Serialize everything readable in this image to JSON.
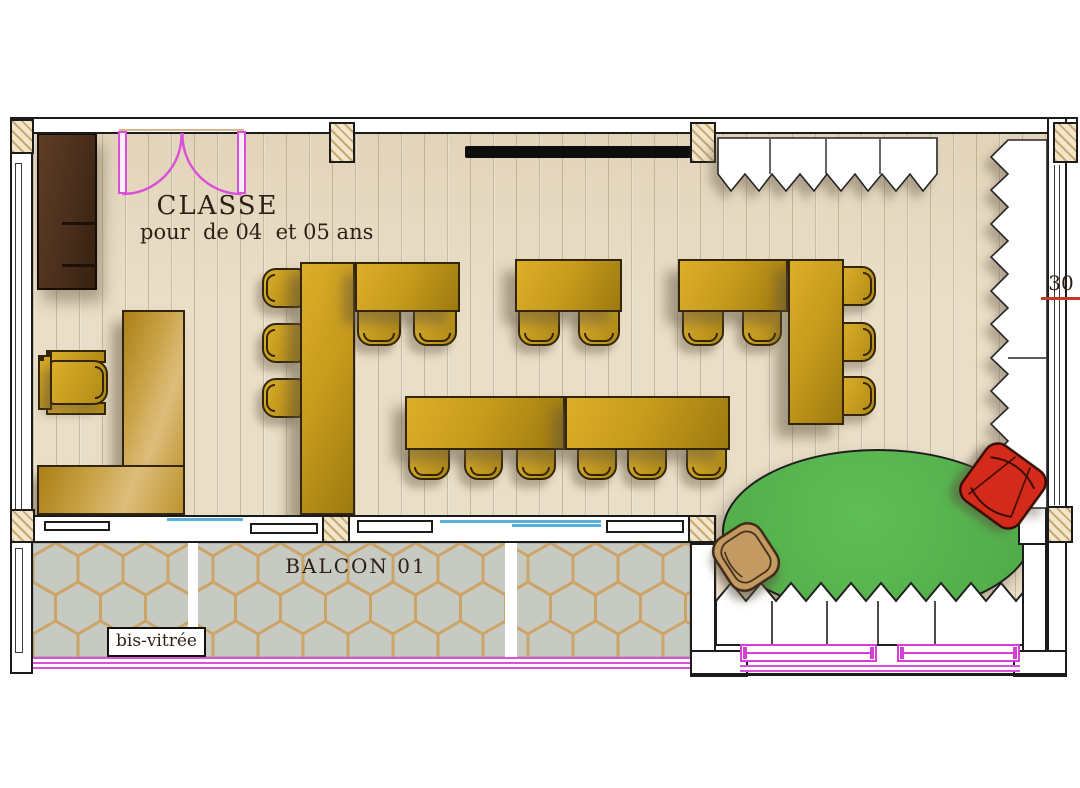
{
  "labels": {
    "room_name": "CLASSE",
    "room_subtitle": "pour  de 04  et 05 ans",
    "balcony": "BALCON 01",
    "glazing": "bis-vitrée",
    "dimension": "30"
  },
  "colors": {
    "floor_wood": "#e9dec7",
    "plank_line": "#c9b493",
    "wall_fill": "#ffffff",
    "wall_line": "#1b1b1b",
    "column_hatch": "#c8a96f",
    "furniture_gold": "#cf9f1d",
    "teacher_desk_tan": "#ddbd7c",
    "cabinet_brown": "#4a2f1c",
    "rug_green": "#54b24c",
    "armchair_red": "#d42a1a",
    "basket_tan": "#c49a63",
    "door_magenta": "#d94fd9",
    "window_magenta": "#d63fd6",
    "glass_cyan": "#58b0d6",
    "balcony_tile": "#c7cac3",
    "tile_grout": "#cda468",
    "blackboard_black": "#0d0d0d",
    "dimension_red": "#c23b2a"
  },
  "inventory": {
    "student_table_units": 7,
    "student_chairs": 18,
    "teacher_desk": 1,
    "teacher_chair": 1,
    "storage_cabinet": 1,
    "blackboard": 1,
    "rug": 1,
    "armchair": 1,
    "basket": 1,
    "double_door": 1
  }
}
